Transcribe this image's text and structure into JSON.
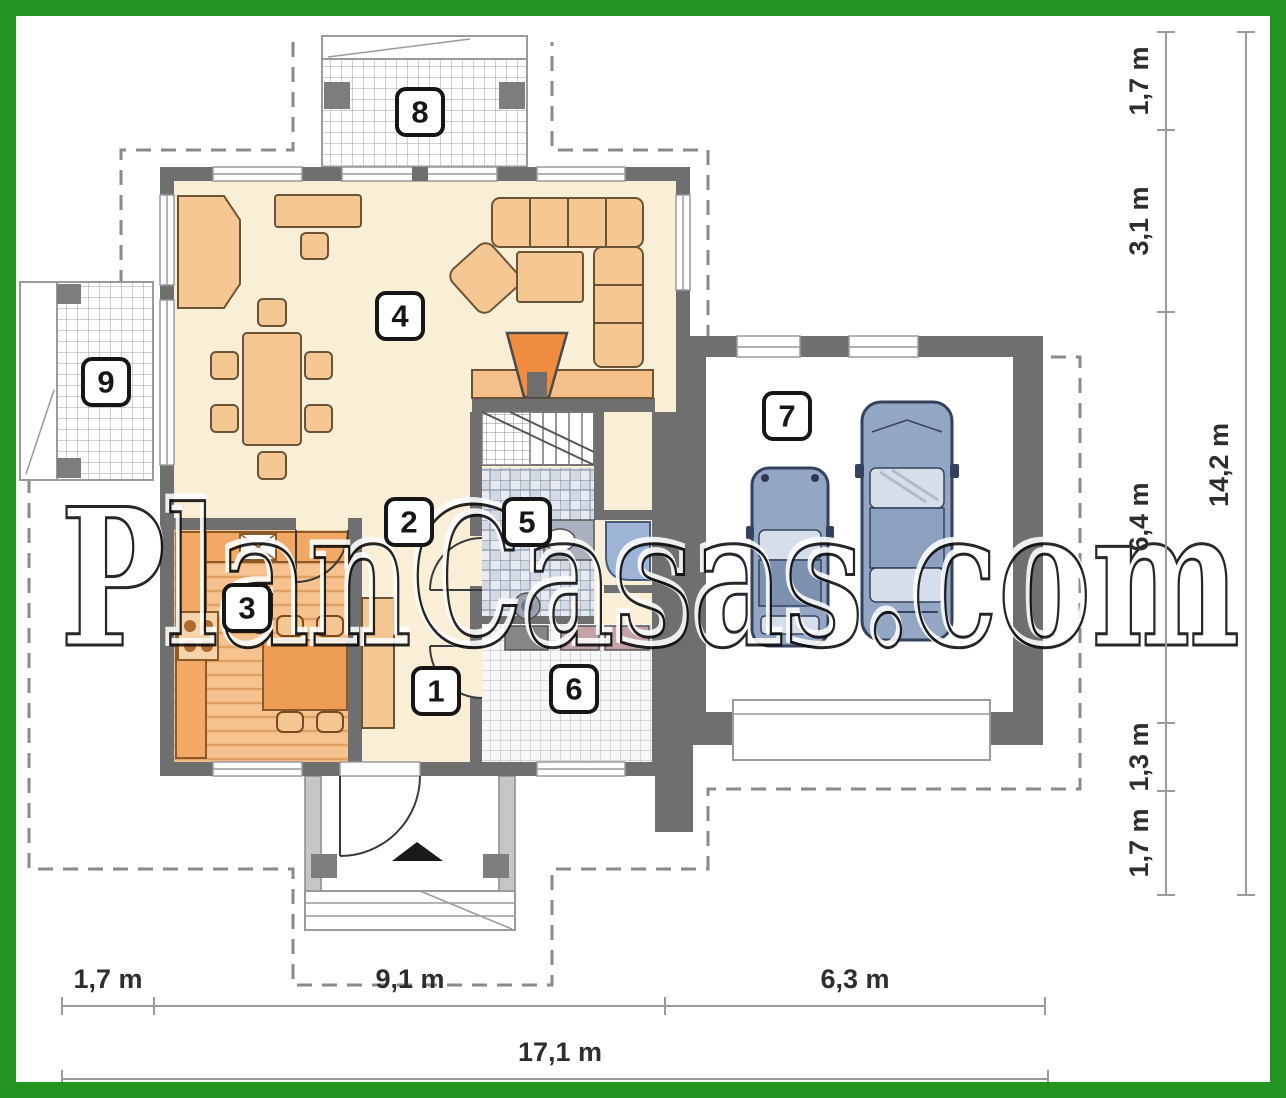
{
  "watermark": {
    "text": "PlanCasas.com"
  },
  "rooms": [
    {
      "number": "1"
    },
    {
      "number": "2"
    },
    {
      "number": "3"
    },
    {
      "number": "4"
    },
    {
      "number": "5"
    },
    {
      "number": "6"
    },
    {
      "number": "7"
    },
    {
      "number": "8"
    },
    {
      "number": "9"
    }
  ],
  "dimensions": {
    "bottom": {
      "segments": [
        "1,7 m",
        "9,1 m",
        "6,3 m"
      ],
      "total": "17,1 m"
    },
    "right": {
      "segments": [
        "1,7 m",
        "3,1 m",
        "6,4 m",
        "1,3 m",
        "1,7 m"
      ],
      "total": "14,2 m"
    }
  },
  "colors": {
    "frame_green": "#229422",
    "wall_gray": "#6f6f6f",
    "floor_cream": "#f9eed6",
    "kitchen_orange": "#f2a966",
    "furniture_tan": "#f4c793",
    "fireplace_orange": "#ef8c3e",
    "car_blue": "#93a6c4",
    "bath_tile": "#e7ebf1"
  }
}
